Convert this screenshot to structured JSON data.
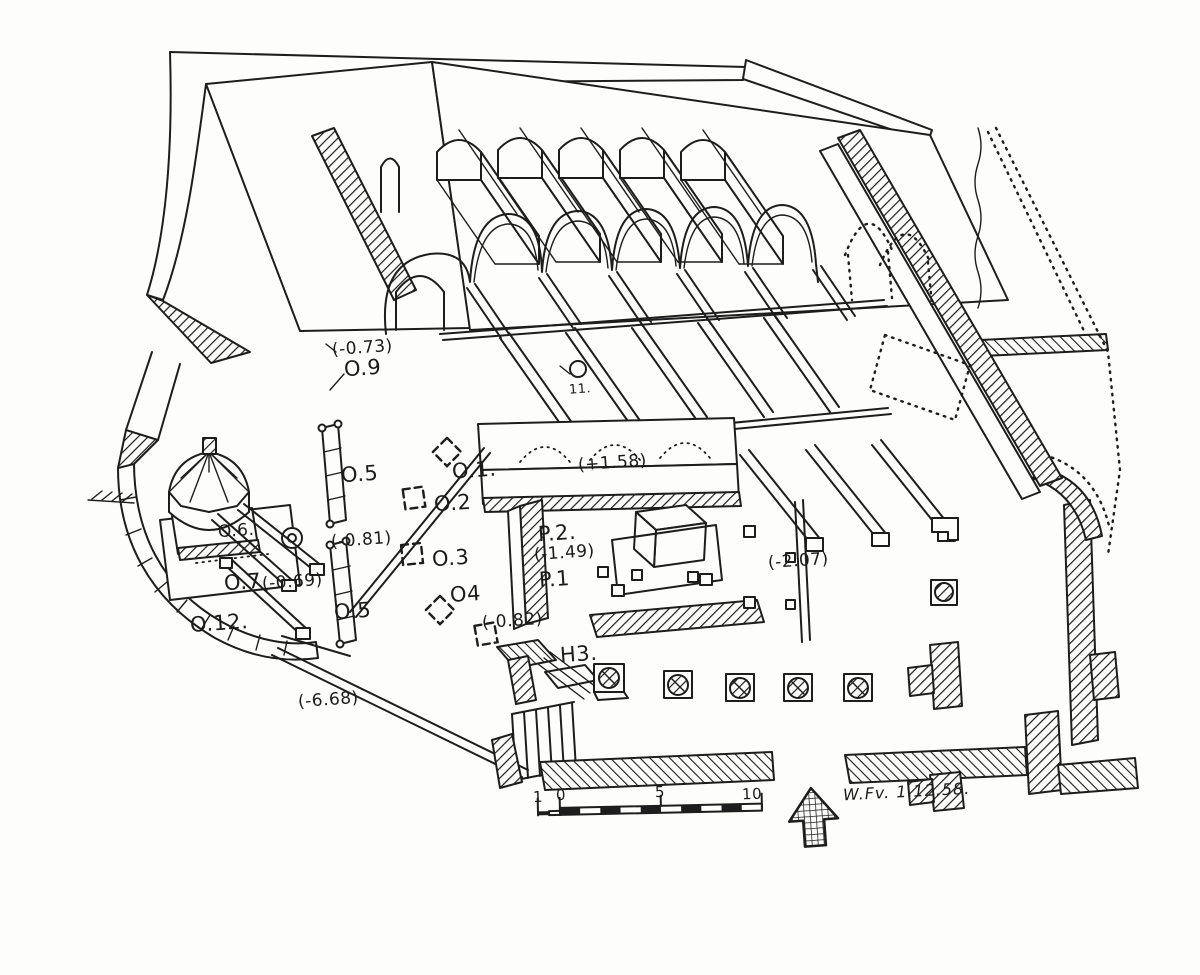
{
  "drawing": {
    "kind": "hand-drawn axonometric cutaway of excavated building",
    "ink_color": "#1d1d1d",
    "paper_color": "#fdfdfb"
  },
  "annotations": [
    {
      "id": "elev-073",
      "label": "(-0.73)"
    },
    {
      "id": "point-o9",
      "label": "O.9"
    },
    {
      "id": "point-o5-upper",
      "label": "O.5"
    },
    {
      "id": "point-o1",
      "label": "O.1."
    },
    {
      "id": "point-o2",
      "label": "O.2"
    },
    {
      "id": "elev-081",
      "label": "(-0.81)"
    },
    {
      "id": "point-o6",
      "label": "O.6."
    },
    {
      "id": "point-o7",
      "label": "O.7"
    },
    {
      "id": "elev-069",
      "label": "(-0.69)"
    },
    {
      "id": "point-o5-lower",
      "label": "O.5"
    },
    {
      "id": "point-o12",
      "label": "O.12."
    },
    {
      "id": "point-o3",
      "label": "O.3"
    },
    {
      "id": "point-o4",
      "label": "O4"
    },
    {
      "id": "point-11",
      "label": "11."
    },
    {
      "id": "elev-plus158",
      "label": "(+1.58)"
    },
    {
      "id": "point-p2",
      "label": "P.2."
    },
    {
      "id": "elev-149",
      "label": "(-1.49)"
    },
    {
      "id": "point-p1",
      "label": "P.1"
    },
    {
      "id": "elev-082",
      "label": "(-0.82)"
    },
    {
      "id": "point-h3",
      "label": "H3."
    },
    {
      "id": "elev-207",
      "label": "(-2.07)"
    },
    {
      "id": "elev-668",
      "label": "(-6.68)"
    }
  ],
  "scale_bar": {
    "labels": [
      "1",
      "0",
      "5",
      "10"
    ]
  },
  "north_arrow": {
    "icon": "cross-hatched arrow pointing up"
  },
  "signature": {
    "text": "W.Fv. 1.12.58."
  }
}
